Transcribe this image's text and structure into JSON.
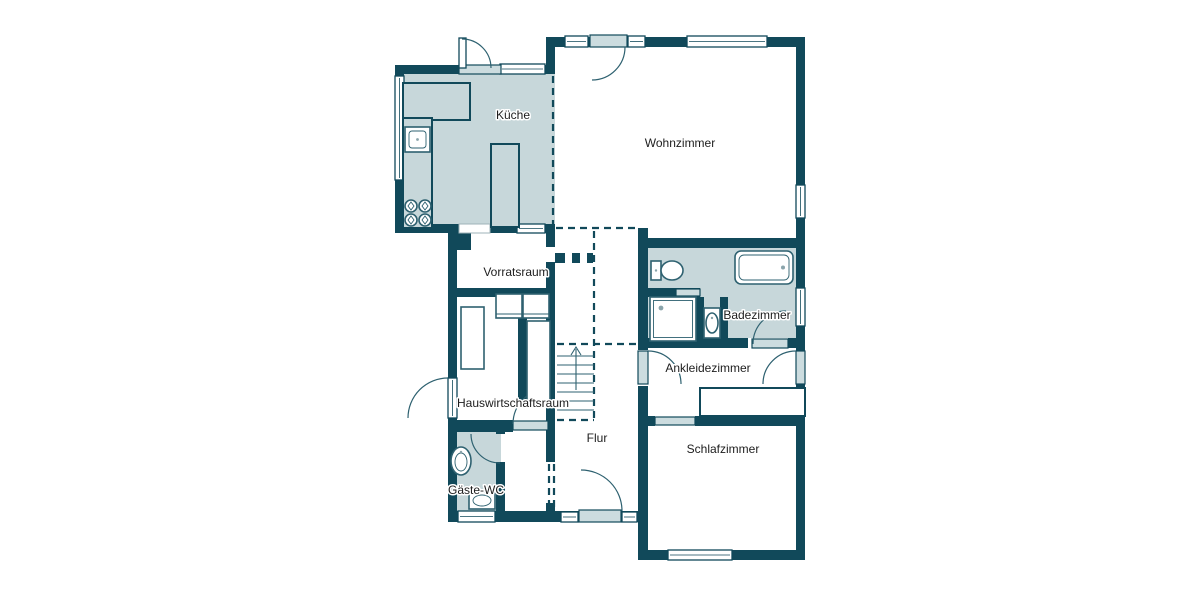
{
  "plan": {
    "rooms": {
      "kueche": {
        "label": "Küche",
        "fill": "light"
      },
      "wohnzimmer": {
        "label": "Wohnzimmer",
        "fill": "white"
      },
      "vorratsraum": {
        "label": "Vorratsraum",
        "fill": "white"
      },
      "badezimmer": {
        "label": "Badezimmer",
        "fill": "light"
      },
      "ankleidezimmer": {
        "label": "Ankleidezimmer",
        "fill": "white"
      },
      "hauswirtschaftsraum": {
        "label": "Hauswirtschaftsraum",
        "fill": "white"
      },
      "flur": {
        "label": "Flur",
        "fill": "white"
      },
      "gaeste_wc": {
        "label": "Gäste-WC",
        "fill": "light"
      },
      "schlafzimmer": {
        "label": "Schlafzimmer",
        "fill": "white"
      }
    },
    "fixtures": [
      "kitchen-counter",
      "kitchen-island",
      "sink-icon",
      "stove-icon",
      "toilet-icon",
      "bathtub-icon",
      "shower-icon",
      "washbasin-icon",
      "washer-dryer-icon",
      "cabinet",
      "wardrobe",
      "stairs-icon",
      "door-swing-arc",
      "window",
      "entrance-door"
    ],
    "stairs": {
      "direction": "up"
    }
  },
  "colors": {
    "wall": "#11495a",
    "room_fill": "#c7d7da",
    "leaf": "#ccdcdf",
    "fixture_outline": "#2e6170",
    "label_text": "#1d1d1d",
    "background": "#ffffff"
  }
}
